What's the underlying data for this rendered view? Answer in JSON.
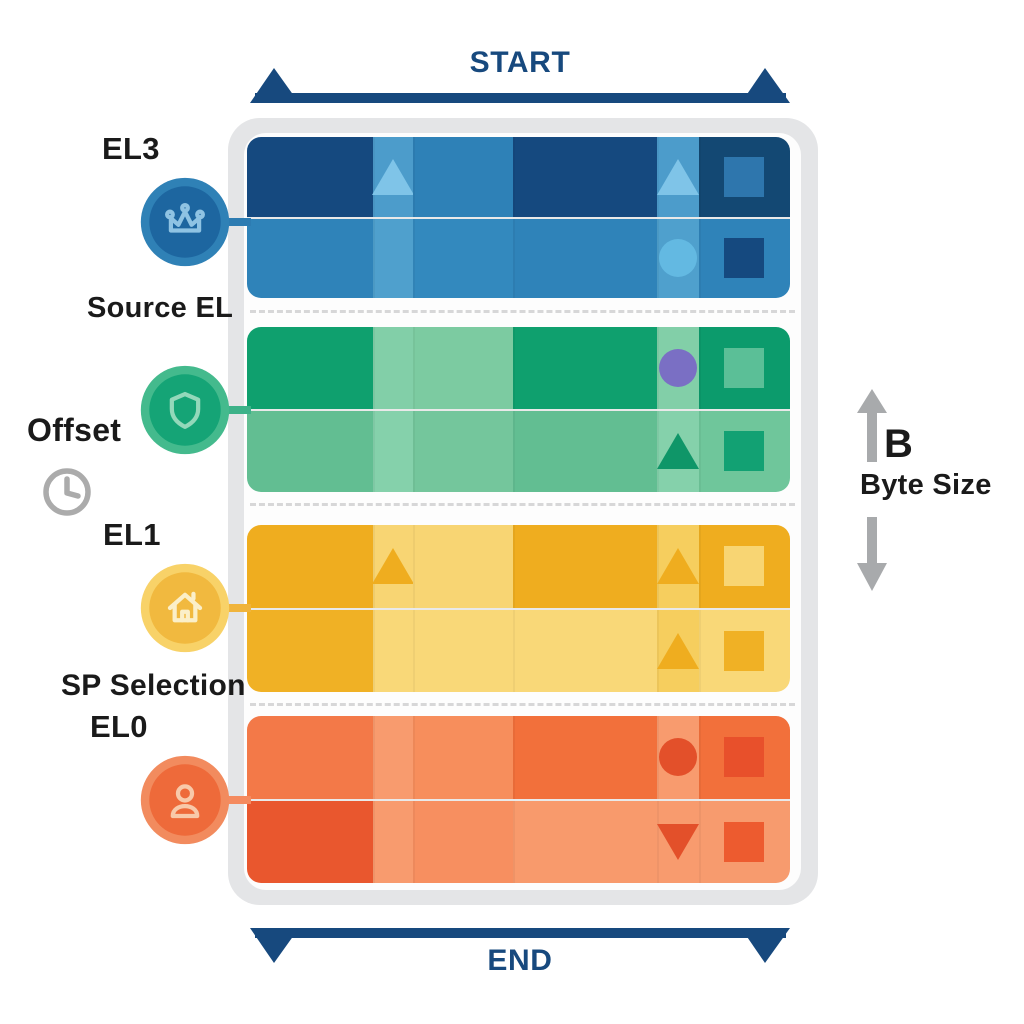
{
  "brackets": {
    "start_label": "START",
    "end_label": "END",
    "color": "#17497e"
  },
  "left_labels": {
    "el3": "EL3",
    "source_el": "Source EL",
    "offset": "Offset",
    "el1": "EL1",
    "sp_selection": "SP Selection",
    "el0": "EL0"
  },
  "byte_size": {
    "letter": "B",
    "label": "Byte Size",
    "arrow_color": "#a8aaac",
    "text_color": "#1a1a1a"
  },
  "clock_icon": {
    "color": "#ababab"
  },
  "panel": {
    "frame_color": "#e4e5e7",
    "inner_color": "#fdfdfd",
    "separator_color": "#d7d7d8"
  },
  "badges": [
    {
      "icon": "crown-icon",
      "ring": "#2f81b6",
      "disc": "#1d66a0",
      "glyph": "#8fc3e3"
    },
    {
      "icon": "shield-icon",
      "ring": "#44ba8d",
      "disc": "#15a476",
      "glyph": "#93d8ba"
    },
    {
      "icon": "home-icon",
      "ring": "#f8d268",
      "disc": "#f1b93f",
      "glyph": "#fbefc9"
    },
    {
      "icon": "person-icon",
      "ring": "#f28b5e",
      "disc": "#ee6a3a",
      "glyph": "#f8c9a9"
    }
  ],
  "bands": [
    {
      "name": "band-blue-el3",
      "connector_color": "#2d7cb2",
      "cells": [
        [
          "#15497f",
          "#4c9ccb",
          "#2e81b7",
          "#15497f",
          "#4c9ccb",
          "#134873"
        ],
        [
          "#2f83b9",
          "#4fa0cd",
          "#3389be",
          "#2f83b9",
          "#4fa0cd",
          "#2f83b9"
        ]
      ],
      "glyphs": [
        {
          "row": 0,
          "col": 1,
          "shape": "triangle-up",
          "color": "#7fc4e8"
        },
        {
          "row": 0,
          "col": 4,
          "shape": "triangle-up",
          "color": "#7fc4e8"
        },
        {
          "row": 1,
          "col": 4,
          "shape": "circle",
          "color": "#63b9e2"
        },
        {
          "row": 0,
          "col": 5,
          "shape": "square",
          "color": "#2e76ad"
        },
        {
          "row": 1,
          "col": 5,
          "shape": "square",
          "color": "#15497f"
        }
      ]
    },
    {
      "name": "band-green",
      "connector_color": "#3db289",
      "cells": [
        [
          "#0fa06e",
          "#82cfa8",
          "#7ccba1",
          "#0fa06e",
          "#82cfa8",
          "#0c9b6c"
        ],
        [
          "#62be92",
          "#85d1ab",
          "#74c69c",
          "#62be92",
          "#85d1ab",
          "#6fc69b"
        ]
      ],
      "glyphs": [
        {
          "row": 0,
          "col": 4,
          "shape": "circle",
          "color": "#7a6fc4"
        },
        {
          "row": 1,
          "col": 4,
          "shape": "triangle-up",
          "color": "#0f9668"
        },
        {
          "row": 0,
          "col": 5,
          "shape": "square",
          "color": "#5bbf97"
        },
        {
          "row": 1,
          "col": 5,
          "shape": "square",
          "color": "#12a173"
        }
      ]
    },
    {
      "name": "band-yellow-el1",
      "connector_color": "#f0b43c",
      "cells": [
        [
          "#efad1f",
          "#f8d573",
          "#f8d573",
          "#efad1f",
          "#f6ce5e",
          "#efad1f"
        ],
        [
          "#f0b125",
          "#f9d878",
          "#f9d878",
          "#f9d878",
          "#f6ce5e",
          "#f9d878"
        ]
      ],
      "glyphs": [
        {
          "row": 0,
          "col": 1,
          "shape": "triangle-up",
          "color": "#efad1f"
        },
        {
          "row": 0,
          "col": 4,
          "shape": "triangle-up",
          "color": "#efad1f"
        },
        {
          "row": 1,
          "col": 4,
          "shape": "triangle-up",
          "color": "#efad1f"
        },
        {
          "row": 0,
          "col": 5,
          "shape": "square",
          "color": "#f8d573"
        },
        {
          "row": 1,
          "col": 5,
          "shape": "square",
          "color": "#f0b125"
        }
      ]
    },
    {
      "name": "band-orange-el0",
      "connector_color": "#f58b60",
      "cells": [
        [
          "#f37948",
          "#f89b6e",
          "#f78e5c",
          "#f2703b",
          "#f89b6e",
          "#f2703b"
        ],
        [
          "#e9572e",
          "#f89b6e",
          "#f78f60",
          "#f89a6c",
          "#f89b6e",
          "#f79b6e"
        ]
      ],
      "glyphs": [
        {
          "row": 0,
          "col": 4,
          "shape": "circle",
          "color": "#e3502a"
        },
        {
          "row": 1,
          "col": 4,
          "shape": "triangle-down",
          "color": "#e3502a"
        },
        {
          "row": 0,
          "col": 5,
          "shape": "square",
          "color": "#e8502b"
        },
        {
          "row": 1,
          "col": 5,
          "shape": "square",
          "color": "#ed5b2f"
        }
      ]
    }
  ]
}
